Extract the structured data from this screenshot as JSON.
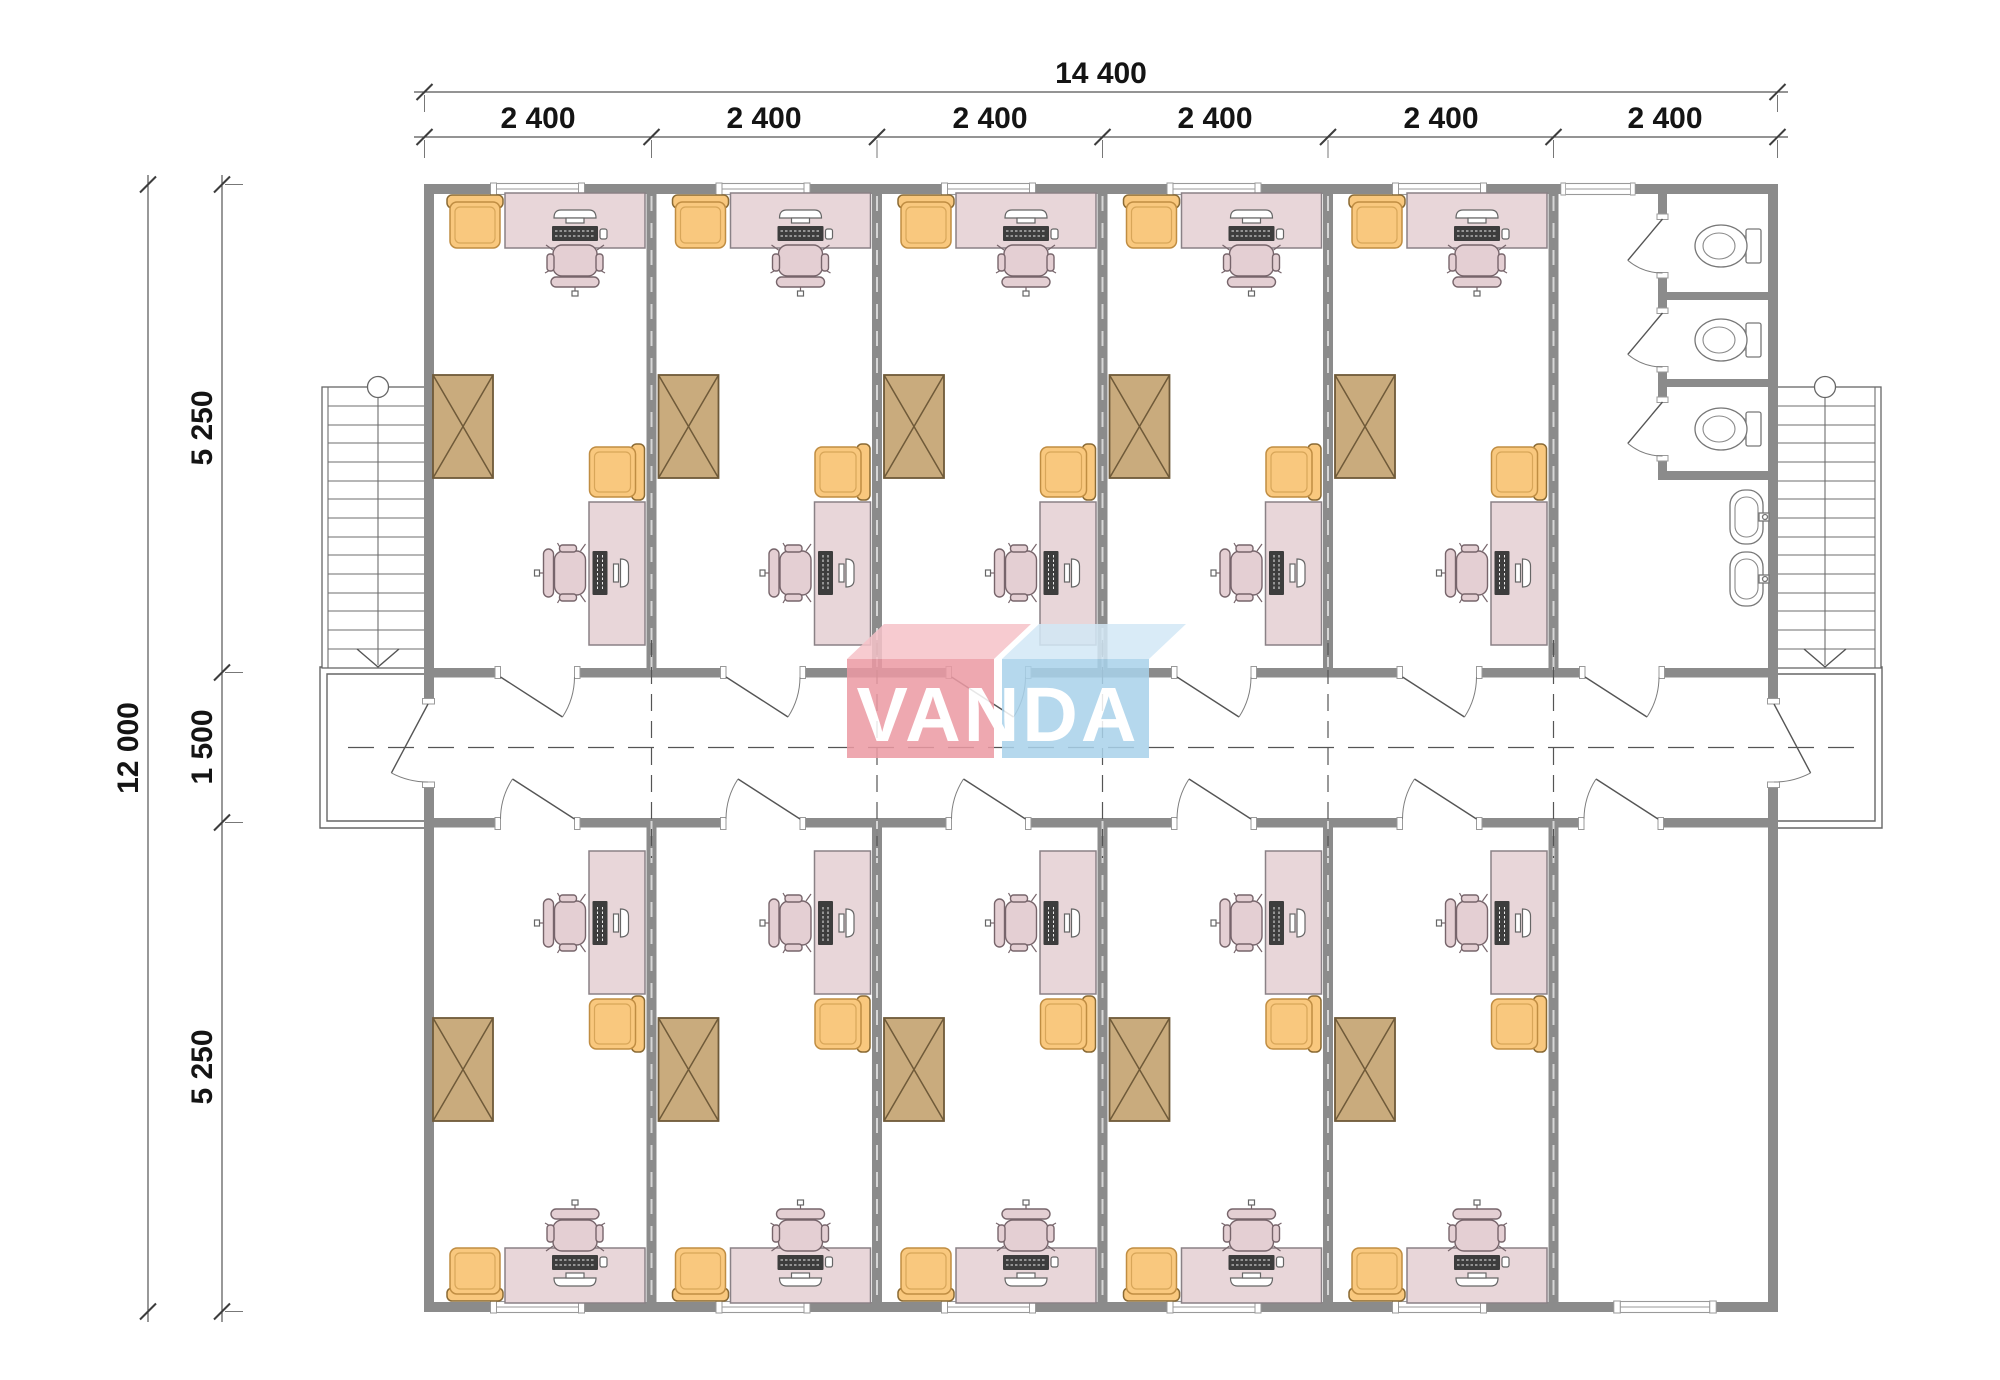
{
  "logo": {
    "text": "VANDA",
    "colors": {
      "pink": "#ec9aa4",
      "pink_top": "#f6c3c9",
      "blue": "#a9d2eb",
      "blue_top": "#d3e8f6",
      "text": "#ffffff"
    }
  },
  "dimensions": {
    "top_total": "14 400",
    "top_segments": [
      "2 400",
      "2 400",
      "2 400",
      "2 400",
      "2 400",
      "2 400"
    ],
    "left_total": "12 000",
    "left_top": "5 250",
    "left_middle": "1 500",
    "left_bottom": "5 250"
  },
  "plan_colors": {
    "wall": "#8b8b8b",
    "desk": "#e8d6d9",
    "chair": "#e4cfd3",
    "armchair": "#f9c87e",
    "armchair_border": "#c08d42",
    "cabinet": "#c9ab7d",
    "cabinet_border": "#6f5a39"
  },
  "icons": {
    "desk": "pink work table with computer",
    "office_chair": "round task chair",
    "guest_armchair": "orange armchair",
    "wardrobe": "rectangle with X cross",
    "toilet": "wc bowl with tank",
    "sink": "washbasin with tap",
    "staircase": "treads with circle and down arrow",
    "door": "leaf with quarter-arc swing"
  }
}
